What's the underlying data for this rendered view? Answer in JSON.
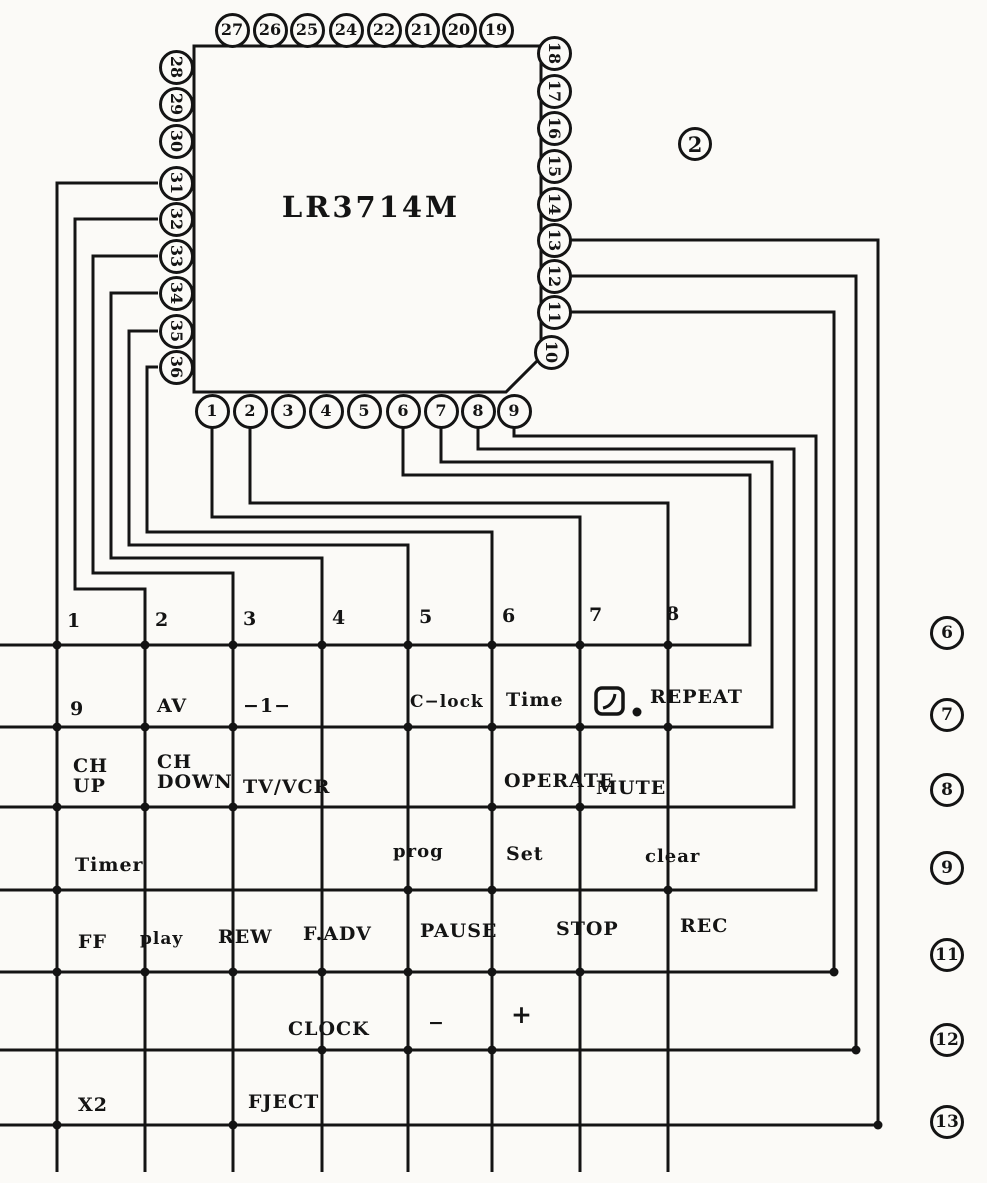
{
  "figure": {
    "number": "2",
    "chip_label": "LR3714M"
  },
  "chip": {
    "outline": "194,46 541,46 541,357 506,392 194,392"
  },
  "pins": {
    "top": [
      {
        "n": "27",
        "c": 232
      },
      {
        "n": "26",
        "c": 270
      },
      {
        "n": "25",
        "c": 307
      },
      {
        "n": "24",
        "c": 346
      },
      {
        "n": "22",
        "c": 384
      },
      {
        "n": "21",
        "c": 422
      },
      {
        "n": "20",
        "c": 459
      },
      {
        "n": "19",
        "c": 496
      }
    ],
    "right": [
      {
        "n": "18",
        "c": 53
      },
      {
        "n": "17",
        "c": 91
      },
      {
        "n": "16",
        "c": 128
      },
      {
        "n": "15",
        "c": 166
      },
      {
        "n": "14",
        "c": 204
      },
      {
        "n": "13",
        "c": 240
      },
      {
        "n": "12",
        "c": 276
      },
      {
        "n": "11",
        "c": 312
      },
      {
        "n": "10",
        "c": 352,
        "cx": 551
      }
    ],
    "left": [
      {
        "n": "28",
        "c": 67
      },
      {
        "n": "29",
        "c": 104
      },
      {
        "n": "30",
        "c": 141
      },
      {
        "n": "31",
        "c": 183
      },
      {
        "n": "32",
        "c": 219
      },
      {
        "n": "33",
        "c": 256
      },
      {
        "n": "34",
        "c": 293
      },
      {
        "n": "35",
        "c": 331
      },
      {
        "n": "36",
        "c": 367
      }
    ],
    "bottom": [
      {
        "n": "1",
        "c": 212
      },
      {
        "n": "2",
        "c": 250
      },
      {
        "n": "3",
        "c": 288
      },
      {
        "n": "4",
        "c": 326
      },
      {
        "n": "5",
        "c": 364
      },
      {
        "n": "6",
        "c": 403
      },
      {
        "n": "7",
        "c": 441
      },
      {
        "n": "8",
        "c": 478
      },
      {
        "n": "9",
        "c": 514
      }
    ]
  },
  "wires": [
    [
      [
        158,
        183
      ],
      [
        57,
        183
      ],
      [
        57,
        1172
      ]
    ],
    [
      [
        158,
        219
      ],
      [
        75,
        219
      ],
      [
        75,
        589
      ],
      [
        145,
        589
      ],
      [
        145,
        1172
      ]
    ],
    [
      [
        158,
        256
      ],
      [
        93,
        256
      ],
      [
        93,
        573
      ],
      [
        233,
        573
      ],
      [
        233,
        1172
      ]
    ],
    [
      [
        158,
        293
      ],
      [
        111,
        293
      ],
      [
        111,
        558
      ],
      [
        322,
        558
      ],
      [
        322,
        1172
      ]
    ],
    [
      [
        158,
        331
      ],
      [
        129,
        331
      ],
      [
        129,
        545
      ],
      [
        408,
        545
      ],
      [
        408,
        1172
      ]
    ],
    [
      [
        158,
        367
      ],
      [
        147,
        367
      ],
      [
        147,
        532
      ],
      [
        492,
        532
      ],
      [
        492,
        1172
      ]
    ],
    [
      [
        212,
        428
      ],
      [
        212,
        517
      ],
      [
        580,
        517
      ],
      [
        580,
        1172
      ]
    ],
    [
      [
        250,
        428
      ],
      [
        250,
        503
      ],
      [
        668,
        503
      ],
      [
        668,
        1172
      ]
    ],
    [
      [
        403,
        428
      ],
      [
        403,
        475
      ],
      [
        750,
        475
      ],
      [
        750,
        645
      ],
      [
        0,
        645
      ]
    ],
    [
      [
        441,
        428
      ],
      [
        441,
        462
      ],
      [
        772,
        462
      ],
      [
        772,
        727
      ],
      [
        0,
        727
      ]
    ],
    [
      [
        478,
        428
      ],
      [
        478,
        449
      ],
      [
        794,
        449
      ],
      [
        794,
        807
      ],
      [
        0,
        807
      ]
    ],
    [
      [
        514,
        428
      ],
      [
        514,
        436
      ],
      [
        816,
        436
      ],
      [
        816,
        890
      ],
      [
        0,
        890
      ]
    ],
    [
      [
        571,
        312
      ],
      [
        834,
        312
      ],
      [
        834,
        972
      ],
      [
        0,
        972
      ]
    ],
    [
      [
        571,
        276
      ],
      [
        856,
        276
      ],
      [
        856,
        1050
      ],
      [
        0,
        1050
      ]
    ],
    [
      [
        571,
        240
      ],
      [
        878,
        240
      ],
      [
        878,
        1125
      ],
      [
        0,
        1125
      ]
    ]
  ],
  "dots": [
    [
      57,
      645
    ],
    [
      145,
      645
    ],
    [
      233,
      645
    ],
    [
      322,
      645
    ],
    [
      408,
      645
    ],
    [
      492,
      645
    ],
    [
      580,
      645
    ],
    [
      668,
      645
    ],
    [
      57,
      727
    ],
    [
      145,
      727
    ],
    [
      233,
      727
    ],
    [
      408,
      727
    ],
    [
      492,
      727
    ],
    [
      580,
      727
    ],
    [
      668,
      727
    ],
    [
      57,
      807
    ],
    [
      145,
      807
    ],
    [
      233,
      807
    ],
    [
      492,
      807
    ],
    [
      580,
      807
    ],
    [
      57,
      890
    ],
    [
      408,
      890
    ],
    [
      492,
      890
    ],
    [
      668,
      890
    ],
    [
      57,
      972
    ],
    [
      145,
      972
    ],
    [
      233,
      972
    ],
    [
      322,
      972
    ],
    [
      408,
      972
    ],
    [
      492,
      972
    ],
    [
      580,
      972
    ],
    [
      322,
      1050
    ],
    [
      408,
      1050
    ],
    [
      492,
      1050
    ],
    [
      57,
      1125
    ],
    [
      233,
      1125
    ],
    [
      834,
      972
    ],
    [
      856,
      1050
    ],
    [
      878,
      1125
    ]
  ],
  "repeat_icon": {
    "x": 596,
    "y": 688,
    "w": 27,
    "h": 26,
    "dot_x": 637,
    "dot_y": 712
  },
  "row_labels": [
    {
      "t": "6",
      "cy": 633
    },
    {
      "t": "7",
      "cy": 715
    },
    {
      "t": "8",
      "cy": 790
    },
    {
      "t": "9",
      "cy": 868
    },
    {
      "t": "11",
      "cy": 955
    },
    {
      "t": "12",
      "cy": 1040
    },
    {
      "t": "13",
      "cy": 1122
    }
  ],
  "keys": [
    {
      "t": "1",
      "x": 67,
      "y": 611
    },
    {
      "t": "2",
      "x": 155,
      "y": 610
    },
    {
      "t": "3",
      "x": 243,
      "y": 609
    },
    {
      "t": "4",
      "x": 332,
      "y": 608
    },
    {
      "t": "5",
      "x": 419,
      "y": 607
    },
    {
      "t": "6",
      "x": 502,
      "y": 606
    },
    {
      "t": "7",
      "x": 589,
      "y": 605
    },
    {
      "t": "8",
      "x": 666,
      "y": 604
    },
    {
      "t": "9",
      "x": 70,
      "y": 699
    },
    {
      "t": "AV",
      "x": 157,
      "y": 696
    },
    {
      "t": "−1−",
      "x": 243,
      "y": 696
    },
    {
      "t": "C−lock",
      "x": 410,
      "y": 692,
      "fs": 17
    },
    {
      "t": "Time",
      "x": 506,
      "y": 690
    },
    {
      "t": "REPEAT",
      "x": 650,
      "y": 687
    },
    {
      "t": "CH\nUP",
      "x": 73,
      "y": 756
    },
    {
      "t": "CH\nDOWN",
      "x": 157,
      "y": 752
    },
    {
      "t": "TV/VCR",
      "x": 243,
      "y": 777
    },
    {
      "t": "OPERATE",
      "x": 504,
      "y": 771
    },
    {
      "t": "MUTE",
      "x": 596,
      "y": 778
    },
    {
      "t": "Timer",
      "x": 75,
      "y": 855
    },
    {
      "t": "prog",
      "x": 393,
      "y": 842,
      "fs": 18
    },
    {
      "t": "Set",
      "x": 506,
      "y": 844
    },
    {
      "t": "clear",
      "x": 645,
      "y": 847,
      "fs": 18
    },
    {
      "t": "FF",
      "x": 78,
      "y": 932
    },
    {
      "t": "play",
      "x": 140,
      "y": 929,
      "fs": 17
    },
    {
      "t": "REW",
      "x": 218,
      "y": 927
    },
    {
      "t": "F.ADV",
      "x": 303,
      "y": 924
    },
    {
      "t": "PAUSE",
      "x": 420,
      "y": 921
    },
    {
      "t": "STOP",
      "x": 556,
      "y": 919
    },
    {
      "t": "REC",
      "x": 680,
      "y": 916
    },
    {
      "t": "CLOCK",
      "x": 288,
      "y": 1019
    },
    {
      "t": "−",
      "x": 428,
      "y": 1013
    },
    {
      "t": "+",
      "x": 511,
      "y": 1005,
      "fs": 25
    },
    {
      "t": "X2",
      "x": 78,
      "y": 1095
    },
    {
      "t": "FJECT",
      "x": 248,
      "y": 1092
    }
  ],
  "style": {
    "ink": "#141414",
    "paper": "#fbfaf7"
  }
}
